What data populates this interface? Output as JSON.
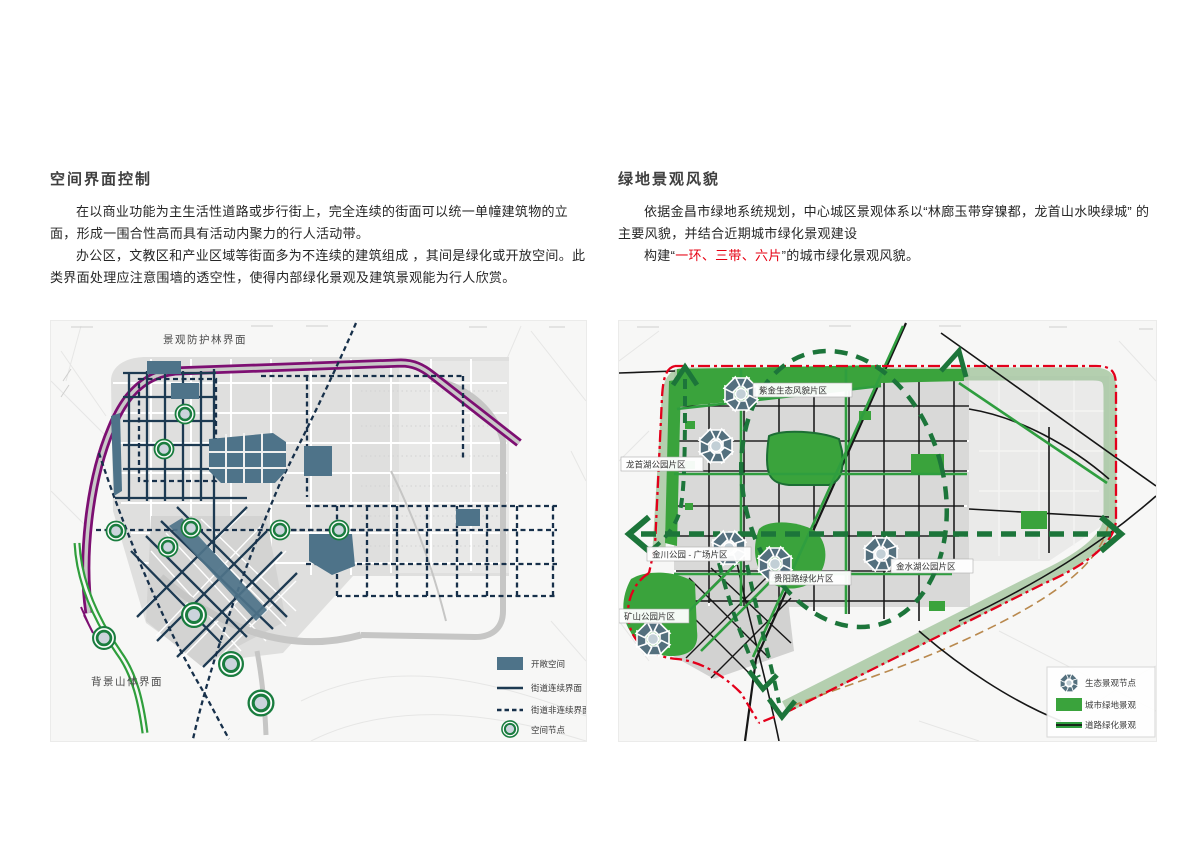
{
  "left_section": {
    "title": "空间界面控制",
    "para1": "在以商业功能为主生活性道路或步行街上，完全连续的街面可以统一单幢建筑物的立面，形成一围合性高而具有活动内聚力的行人活动带。",
    "para2": "办公区，文教区和产业区域等街面多为不连续的建筑组成 ，其间是绿化或开放空间。此类界面处理应注意围墙的透空性，使得内部绿化景观及建筑景观能为行人欣赏。",
    "map": {
      "label_top": "景观防护林界面",
      "label_bottom": "背景山体界面",
      "legend": {
        "open_space": "开敞空间",
        "continuous": "街道连续界面",
        "noncontinuous": "街道非连续界面",
        "node": "空间节点"
      }
    }
  },
  "right_section": {
    "title": "绿地景观风貌",
    "para1": "依据金昌市绿地系统规划，中心城区景观体系以“林廊玉带穿镍都，龙首山水映绿城” 的主要风貌，并结合近期城市绿化景观建设",
    "para2_prefix": "构建“",
    "para2_red": "一环、三带、六片",
    "para2_suffix": "”的城市绿化景观风貌。",
    "map": {
      "labels": {
        "zijin": "紫金生态风貌片区",
        "longshou": "龙首湖公园片区",
        "jinchuan": "金川公园 - 广场片区",
        "guiyang": "贵阳路绿化片区",
        "jinshui": "金水湖公园片区",
        "kuangshan": "矿山公园片区"
      },
      "legend": {
        "eco_node": "生态景观节点",
        "urban_green": "城市绿地景观",
        "road_green": "道路绿化景观"
      }
    }
  },
  "colors": {
    "accent_red": "#e60012",
    "boundary_red": "#e3001b",
    "purple_band": "#7d0f72",
    "teal_open_space": "#4e7389",
    "navy_line": "#1d3a52",
    "node_green": "#1a7d3f",
    "bright_green": "#3aa33c",
    "dark_green": "#1c753a",
    "ring_band_green": "#a3c49e",
    "body_text": "#262626"
  }
}
